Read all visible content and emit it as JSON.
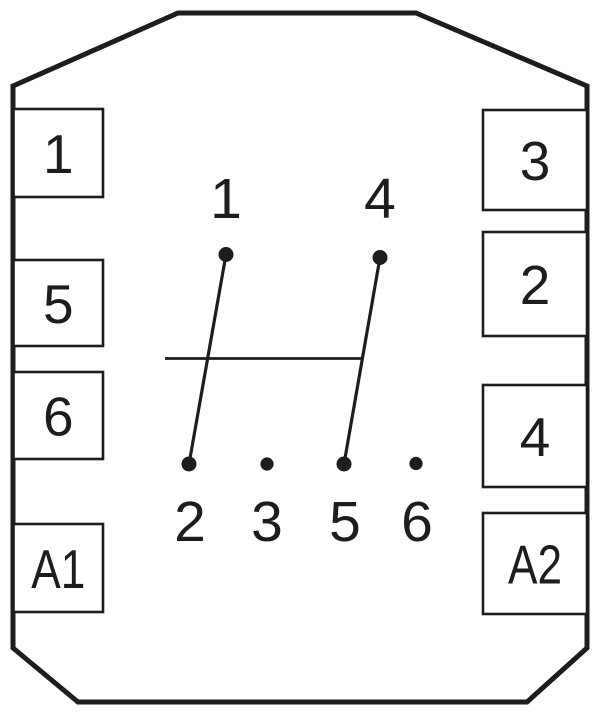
{
  "diagram": {
    "type": "relay-terminal-pin-diagram",
    "colors": {
      "background": "#ffffff",
      "line": "#1d1d1b"
    },
    "outline": {
      "shape": "octagon",
      "stroke_width": 5,
      "points": [
        [
          178,
          13
        ],
        [
          416,
          13
        ],
        [
          587,
          86
        ],
        [
          587,
          648
        ],
        [
          527,
          702
        ],
        [
          78,
          702
        ],
        [
          13,
          648
        ],
        [
          13,
          86
        ]
      ]
    },
    "box_stroke_width": 2.6,
    "terminal_boxes": [
      {
        "side": "left",
        "label": "1",
        "x": 13.5,
        "y": 109,
        "w": 89.5,
        "h": 88
      },
      {
        "side": "left",
        "label": "5",
        "x": 13.5,
        "y": 260,
        "w": 89.5,
        "h": 86
      },
      {
        "side": "left",
        "label": "6",
        "x": 13.5,
        "y": 372,
        "w": 89.5,
        "h": 87
      },
      {
        "side": "left",
        "label": "A1",
        "x": 13.5,
        "y": 524,
        "w": 89.5,
        "h": 88
      },
      {
        "side": "right",
        "label": "3",
        "x": 483,
        "y": 110,
        "w": 104,
        "h": 100
      },
      {
        "side": "right",
        "label": "2",
        "x": 483,
        "y": 232,
        "w": 104,
        "h": 104
      },
      {
        "side": "right",
        "label": "4",
        "x": 483,
        "y": 385,
        "w": 104,
        "h": 102
      },
      {
        "side": "right",
        "label": "A2",
        "x": 483,
        "y": 513,
        "w": 104,
        "h": 101
      }
    ],
    "pins": [
      {
        "id": "pin-1",
        "label": "1",
        "row": "top",
        "x": 226,
        "y": 254.5,
        "r": 7.5,
        "label_x": 226,
        "label_y": 218
      },
      {
        "id": "pin-4",
        "label": "4",
        "row": "top",
        "x": 380,
        "y": 257.5,
        "r": 7.5,
        "label_x": 380,
        "label_y": 218
      },
      {
        "id": "pin-2",
        "label": "2",
        "row": "bottom",
        "x": 189,
        "y": 464,
        "r": 7.5,
        "label_x": 190,
        "label_y": 541
      },
      {
        "id": "pin-3",
        "label": "3",
        "row": "bottom",
        "x": 267,
        "y": 464,
        "r": 6.6,
        "label_x": 267,
        "label_y": 541
      },
      {
        "id": "pin-5",
        "label": "5",
        "row": "bottom",
        "x": 344,
        "y": 464,
        "r": 7.5,
        "label_x": 345,
        "label_y": 541
      },
      {
        "id": "pin-6",
        "label": "6",
        "row": "bottom",
        "x": 416,
        "y": 463.5,
        "r": 6.6,
        "label_x": 417,
        "label_y": 541
      }
    ],
    "contact_line_stroke_width": 3.2,
    "contact_lines": [
      {
        "from": "pin-1",
        "to": "pin-2"
      },
      {
        "from": "pin-4",
        "to": "pin-5"
      }
    ],
    "linkage_line": {
      "x1": 165,
      "y1": 358.5,
      "x2": 363,
      "y2": 358.5,
      "stroke_width": 2.8
    }
  }
}
